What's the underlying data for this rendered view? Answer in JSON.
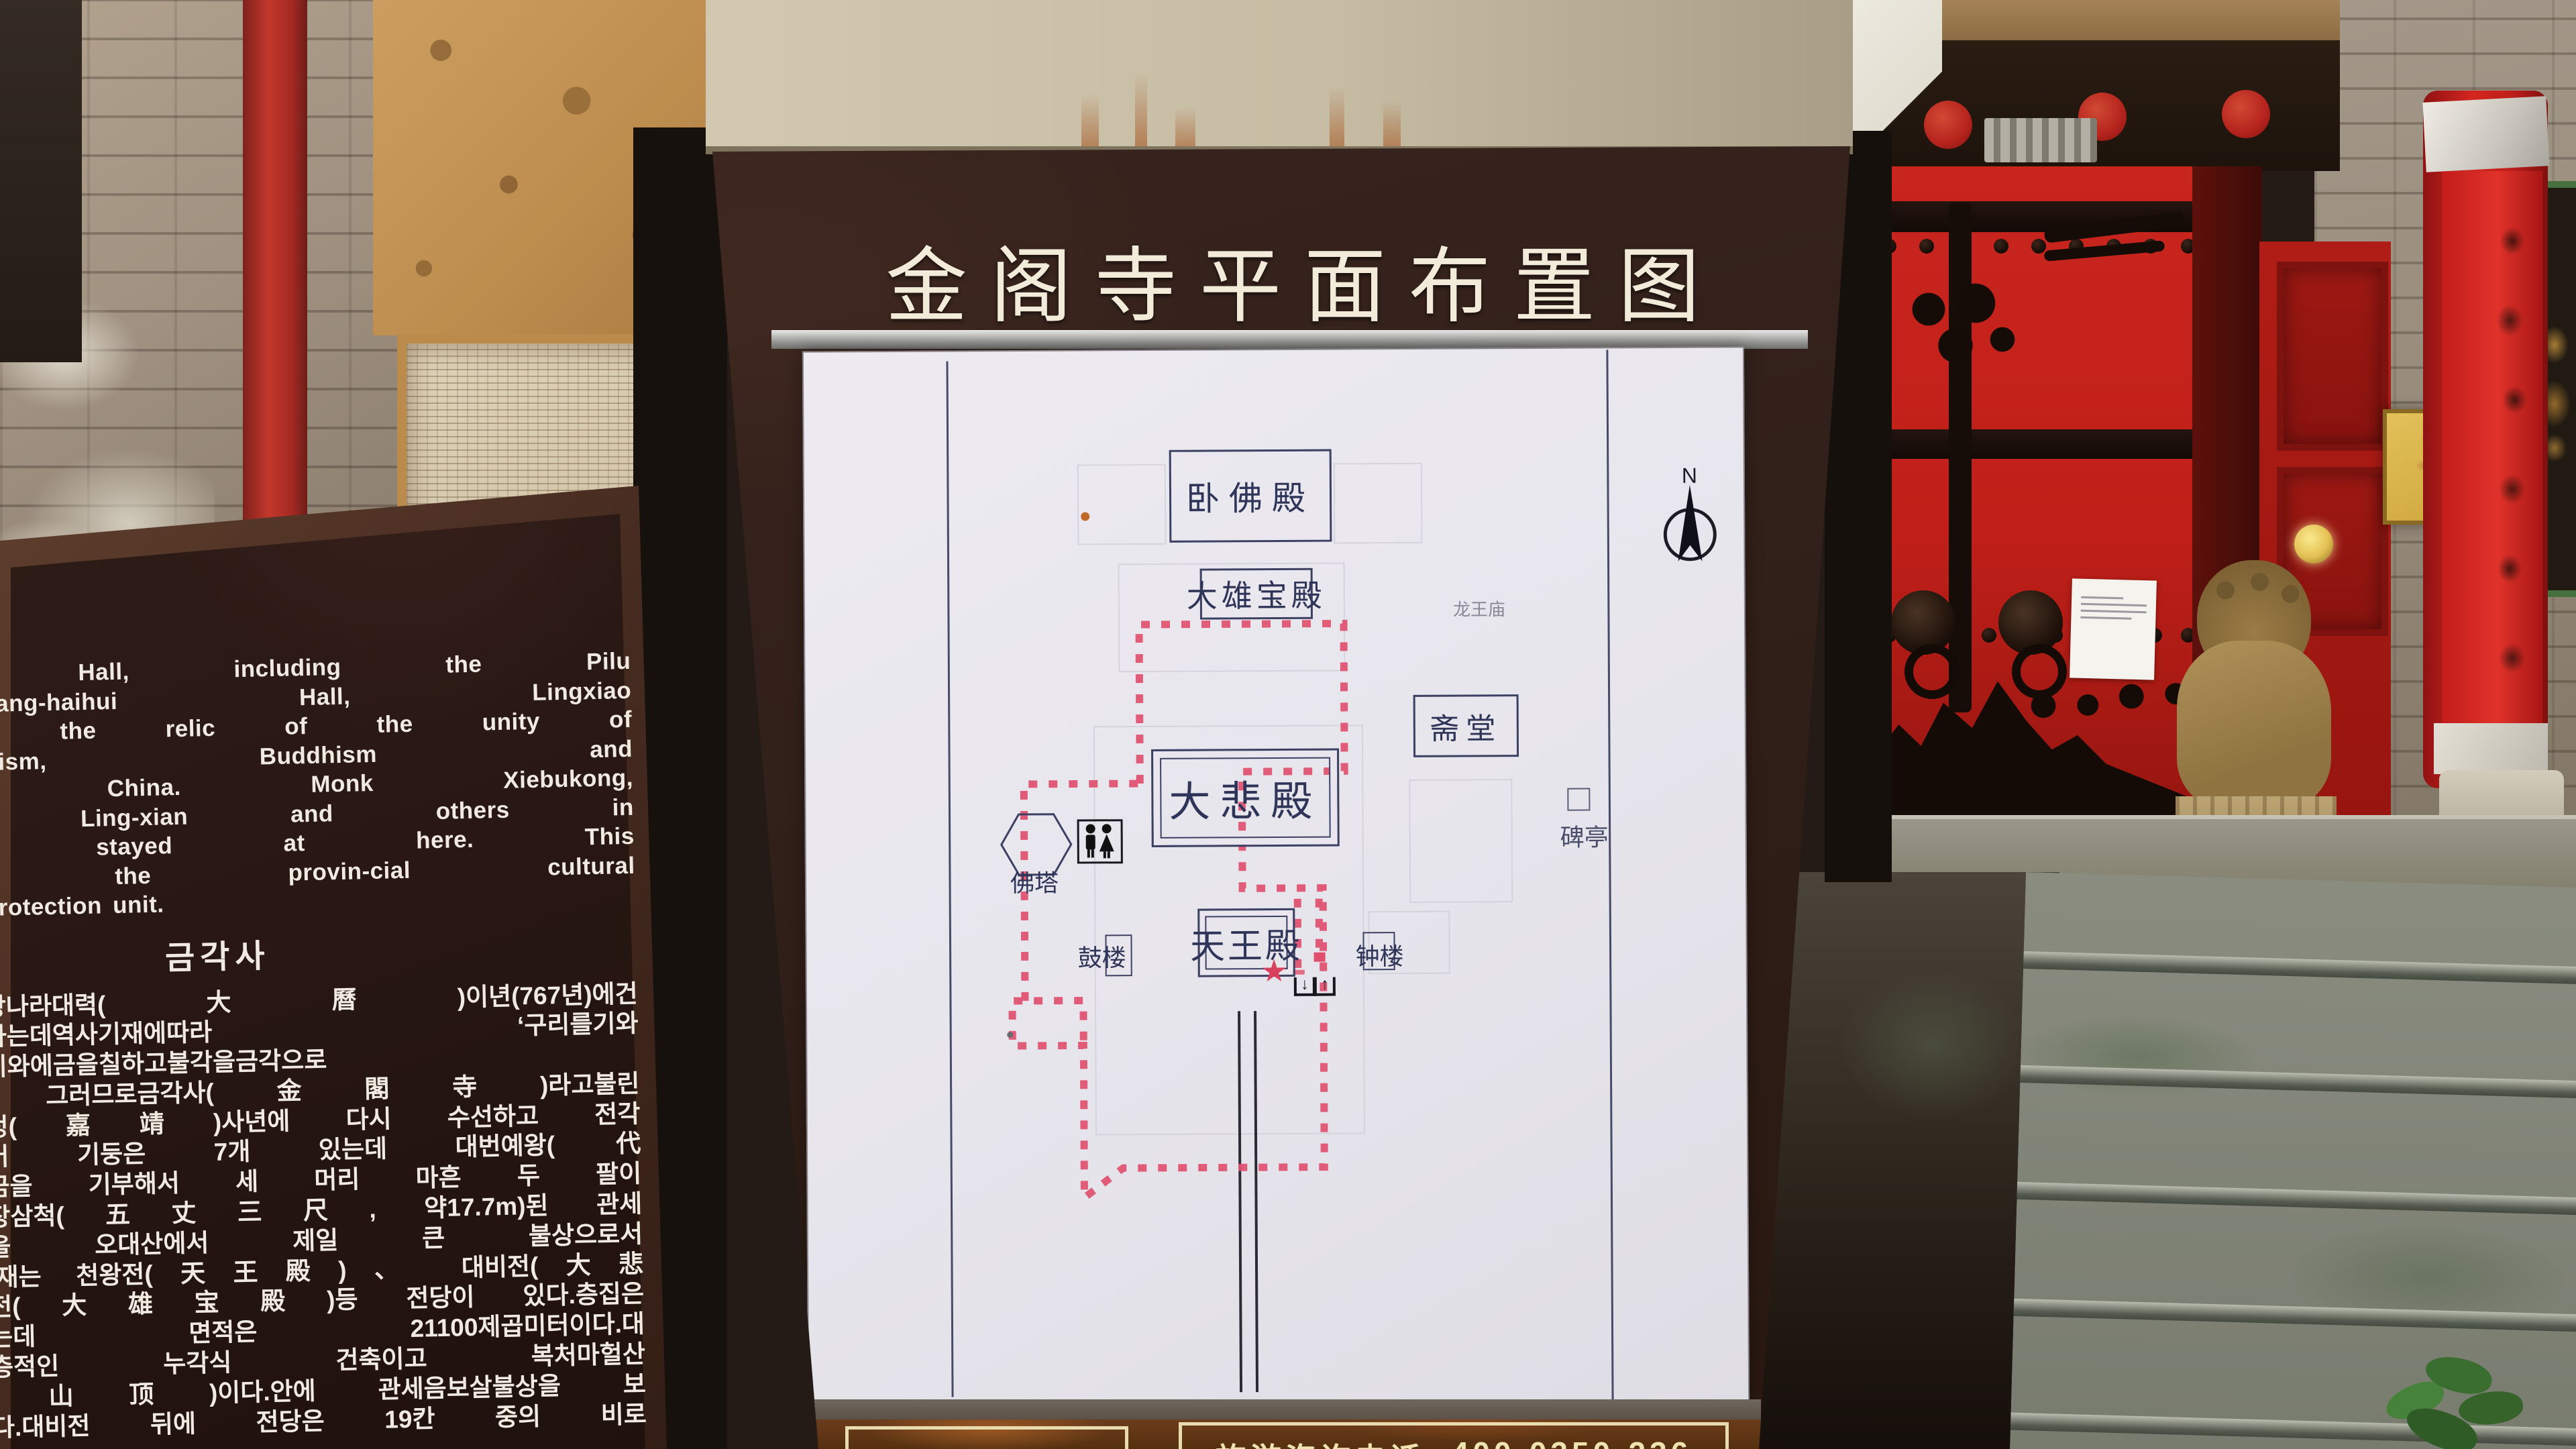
{
  "sign": {
    "title": "金阁寺平面布置图",
    "info_bar": {
      "label": "旅游咨询电话",
      "phone": "400-0350-236"
    }
  },
  "map": {
    "compass": "N",
    "star": "★",
    "arrow_down": "↓",
    "arrow_up": "↑",
    "halls": {
      "wofodian": "卧佛殿",
      "daxiongbaodian": "大雄宝殿",
      "longwangmiao": "龙王庙",
      "zhaitang": "斋堂",
      "dabeidian": "大悲殿",
      "fota": "佛塔",
      "gulou": "鼓楼",
      "tianwangdian": "天王殿",
      "zhonglou": "钟楼",
      "beiting": "碑亭"
    }
  },
  "stele": {
    "english_lines": [
      "ei Hall, including the Pilu",
      "uacang-haihui Hall, Lingxiao",
      "ing the relic of the unity of",
      "ian-ism, Buddhism and",
      "in China. Monk Xiebukong,",
      "g, Ling-xian and others in",
      "ad stayed at here. This",
      "is the provin-cial cultural",
      "d protection unit."
    ],
    "korean_title": "금각사",
    "korean_lines": [
      "는당나라대력(大曆)이년(767년)에건",
      "작하는데역사기재에따라 ‘구리를기와",
      "여기와에금을칠하고불각을금각으로",
      "’, 그러므로금각사(金閣寺)라고불린",
      "가정(嘉靖)사년에 다시 수선하고 전각",
      "되어 기둥은 7개 있는데 대번예왕(代",
      "자금을 기부해서 세 머리 마흔 두 팔이",
      "오장삼척(五丈三尺, 약17.7m)된 관세",
      "상을 오대산에서 제일 큰 불상으로서",
      ".현재는 천왕전(天王殿)、 대비전(大悲",
      "보전(大雄宝殿)등 전당이 있다.층집은",
      "있는데 면적은 21100제곱미터이다.대",
      "이층적인 누각식 건축이고 복처마헐산",
      "歇山顶)이다.안에 관세음보살불상을 보",
      "있다.대비전 뒤에 전당은 19칸 중의 비로"
    ]
  },
  "colors": {
    "route_pink": "#e0506e",
    "map_ink": "#373c5e",
    "board_brown": "#33201a",
    "title_ivory": "#f2ebd9",
    "bar_gold": "#efe3b0",
    "door_red": "#c1211c",
    "pillar_red": "#c6201f"
  }
}
